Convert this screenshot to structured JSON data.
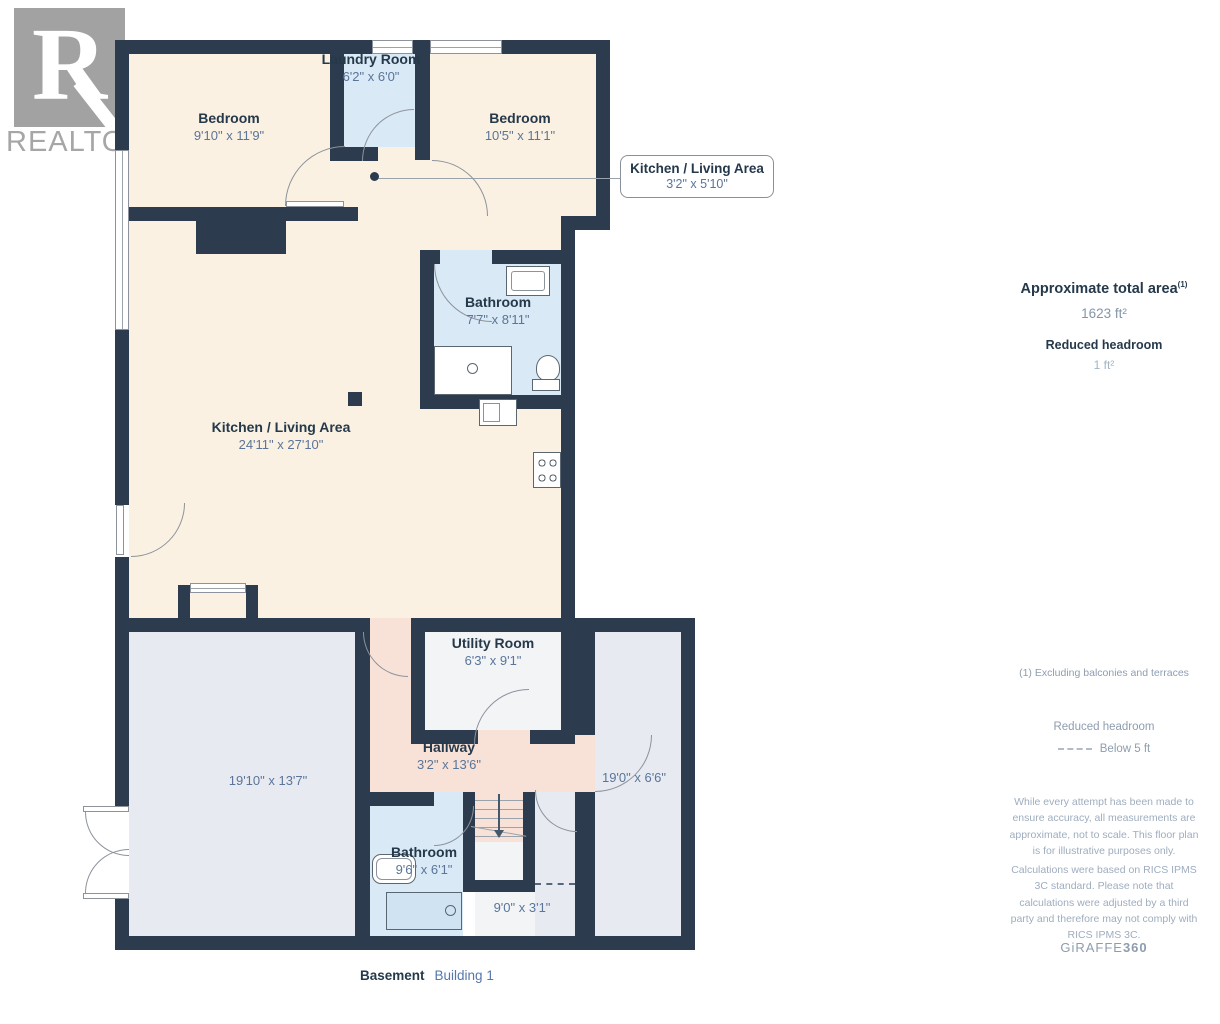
{
  "palette": {
    "wall": "#2c3b4d",
    "room_cream": "#faf1e2",
    "room_blue": "#d9e9f5",
    "room_gray": "#e7ebf1",
    "room_white": "#f2f4f6",
    "room_pink": "#f8e2d8",
    "label_text": "#25394a",
    "dim_text": "#5a7599"
  },
  "logo": {
    "letter": "R",
    "brand": "REALTOR",
    "registered": "®"
  },
  "callout": {
    "title": "Kitchen / Living Area",
    "dims": "3'2\" x 5'10\""
  },
  "rooms": {
    "bedroom1": {
      "name": "Bedroom",
      "dims": "9'10\" x 11'9\""
    },
    "laundry": {
      "name": "Laundry Room",
      "dims": "6'2\" x 6'0\""
    },
    "bedroom2": {
      "name": "Bedroom",
      "dims": "10'5\" x 11'1\""
    },
    "bathroom_upper": {
      "name": "Bathroom",
      "dims": "7'7\" x 8'11\""
    },
    "kitchen": {
      "name": "Kitchen / Living Area",
      "dims": "24'11\" x 27'10\""
    },
    "utility": {
      "name": "Utility Room",
      "dims": "6'3\" x 9'1\""
    },
    "hallway": {
      "name": "Hallway",
      "dims": "3'2\" x 13'6\""
    },
    "rec_room": {
      "dims": "19'10\" x 13'7\""
    },
    "side_room": {
      "dims": "19'0\" x 6'6\""
    },
    "bathroom_lower": {
      "name": "Bathroom",
      "dims": "9'6\" x 6'1\""
    },
    "crawl": {
      "dims": "9'0\" x 3'1\""
    }
  },
  "sidebar": {
    "total_area_label": "Approximate total area",
    "total_area_sup": "(1)",
    "total_area_value": "1623 ft²",
    "reduced_label": "Reduced headroom",
    "reduced_value": "1 ft²",
    "footnote": "(1) Excluding balconies and terraces",
    "legend_title": "Reduced headroom",
    "legend_value": "Below 5 ft",
    "disclaimer1": "While every attempt has been made to ensure accuracy, all measurements are approximate, not to scale. This floor plan is for illustrative purposes only.",
    "disclaimer2": "Calculations were based on RICS IPMS 3C standard. Please note that calculations were adjusted by a third party and therefore may not comply with RICS IPMS 3C.",
    "brand": "GiRAFFE",
    "brand_suffix": "360"
  },
  "footer": {
    "floor": "Basement",
    "building": "Building 1"
  }
}
